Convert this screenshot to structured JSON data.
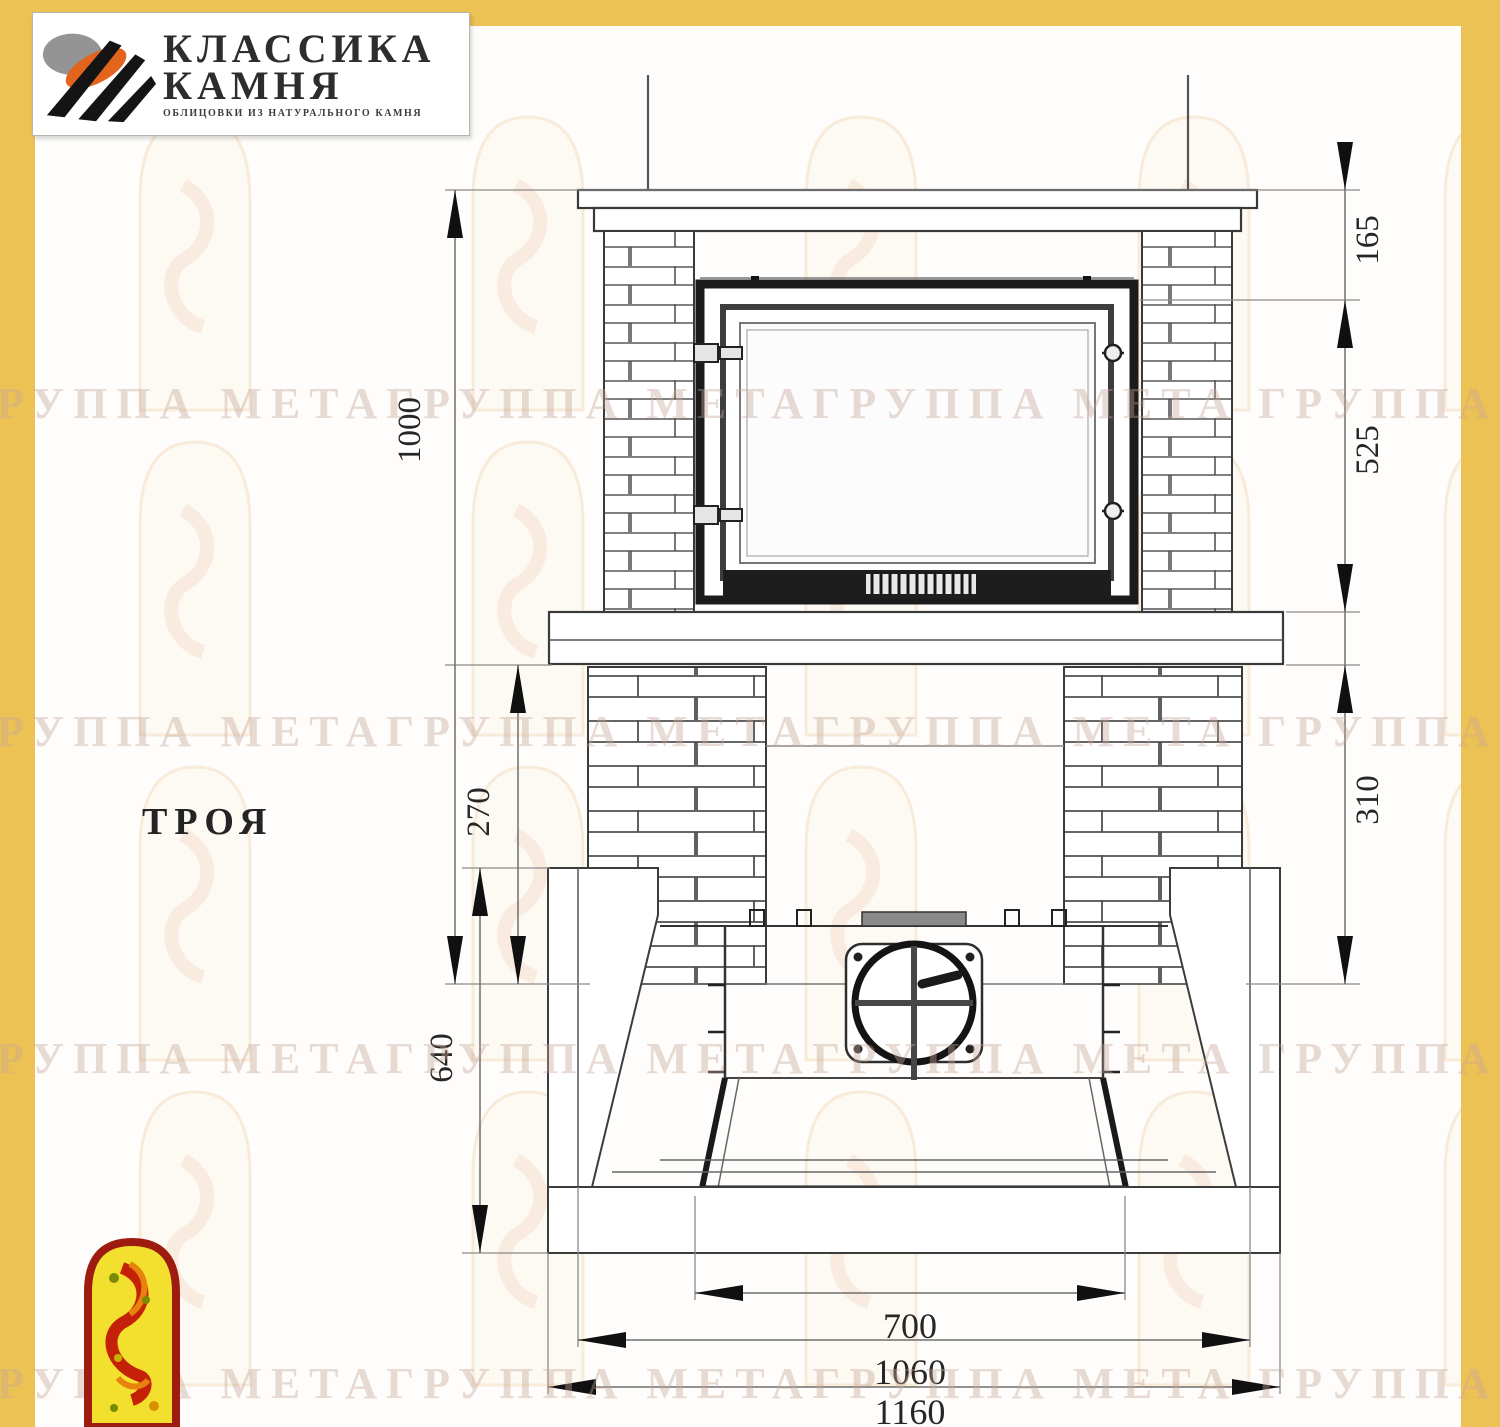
{
  "logo": {
    "title_line1": "КЛАССИКА",
    "title_line2": "КАМНЯ",
    "subtitle": "ОБЛИЦОВКИ ИЗ НАТУРАЛЬНОГО КАМНЯ"
  },
  "model_label": "ТРОЯ",
  "watermark_text": "ГРУППА МЕТАГРУППА МЕТАГРУППА МЕТА ГРУППА МЕТАГРУППА МЕТА",
  "dimensions": {
    "front_view": {
      "overall_height": "1000",
      "shelf_to_firebox_top": "165",
      "firebox_height": "525",
      "niche_height": "270",
      "base_height": "310"
    },
    "plan_view": {
      "depth": "640",
      "firebox_front_width": "700",
      "inner_width": "1060",
      "overall_width": "1160"
    }
  },
  "colors": {
    "frame_yellow": "#edc255",
    "line_dark": "#2f2f2f",
    "logo_orange": "#e3641c",
    "mascot_red": "#9e1b10",
    "mascot_yellow": "#f2df2e",
    "watermark": "#c6a496"
  }
}
